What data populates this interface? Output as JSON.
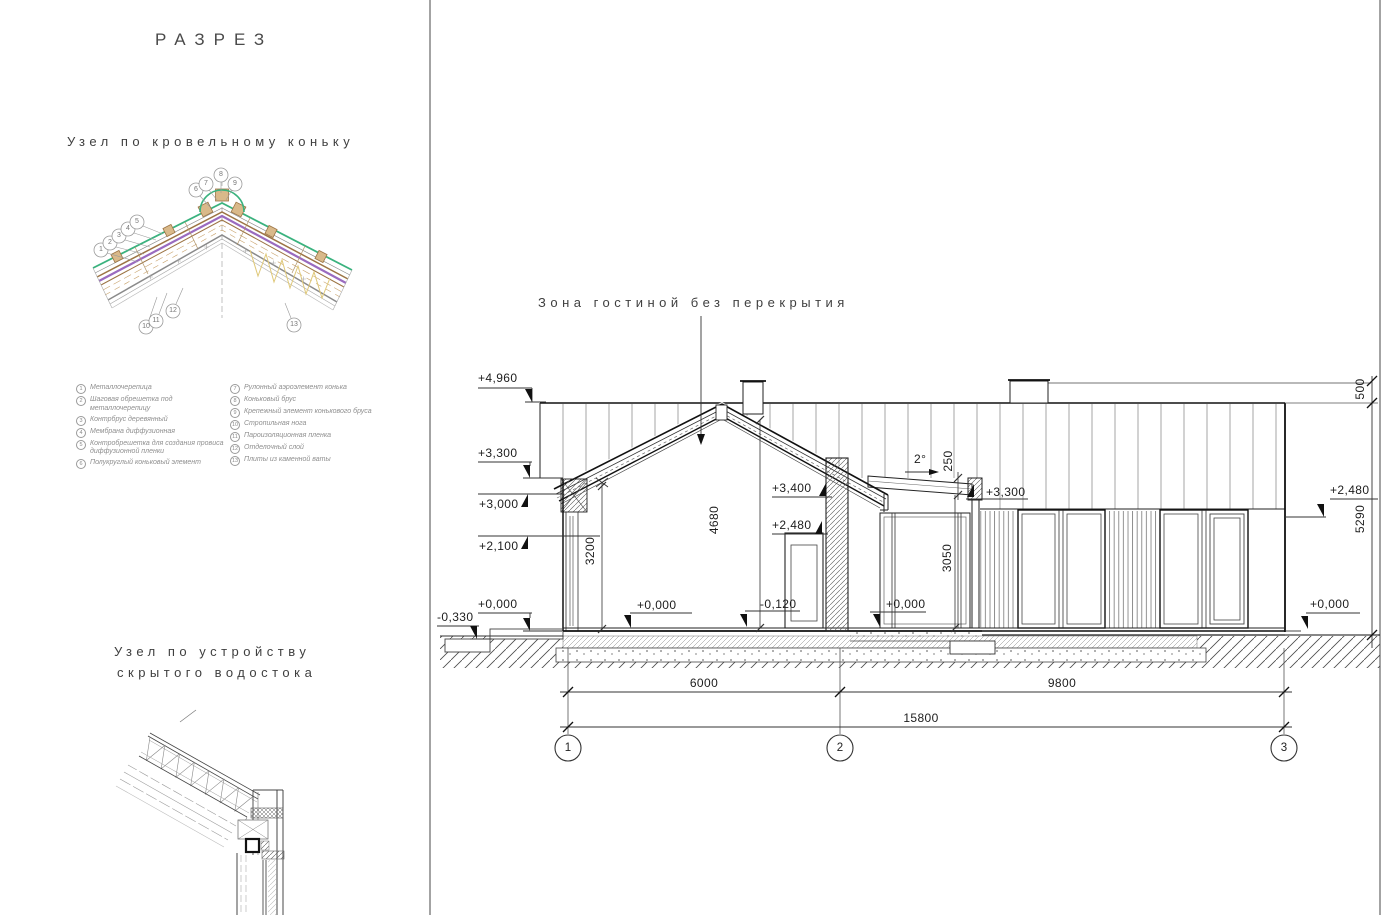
{
  "left_panel": {
    "title": "РАЗРЕЗ",
    "ridge": {
      "heading": "Узел по кровельному коньку",
      "legend_left": [
        {
          "num": "1",
          "text": "Металлочерепица"
        },
        {
          "num": "2",
          "text": "Шаговая обрешетка под металлочерепицу"
        },
        {
          "num": "3",
          "text": "Контрбрус деревянный"
        },
        {
          "num": "4",
          "text": "Мембрана диффузионная"
        },
        {
          "num": "5",
          "text": "Контробрешетка для создания провиса диффузионной пленки"
        },
        {
          "num": "6",
          "text": "Полукруглый коньковый элемент"
        }
      ],
      "legend_right": [
        {
          "num": "7",
          "text": "Рулонный аэроэлемент конька"
        },
        {
          "num": "8",
          "text": "Коньковый брус"
        },
        {
          "num": "9",
          "text": "Крепежный элемент конькового бруса"
        },
        {
          "num": "10",
          "text": "Стропильная нога"
        },
        {
          "num": "11",
          "text": "Пароизоляционная пленка"
        },
        {
          "num": "12",
          "text": "Отделочный слой"
        },
        {
          "num": "13",
          "text": "Плиты из каменной ваты"
        }
      ],
      "callouts": [
        "1",
        "2",
        "3",
        "4",
        "5",
        "6",
        "7",
        "8",
        "9",
        "10",
        "11",
        "12",
        "13"
      ]
    },
    "gutter": {
      "heading1": "Узел по устройству",
      "heading2": "скрытого водостока"
    }
  },
  "section": {
    "zone_label": "Зона гостиной без перекрытия",
    "marks": {
      "m4960": "+4,960",
      "m3300l": "+3,300",
      "m3000": "+3,000",
      "m2100": "+2,100",
      "m0l": "+0,000",
      "mm330": "-0,330",
      "m0int": "+0,000",
      "mm120": "-0,120",
      "m0ter": "+0,000",
      "m3400": "+3,400",
      "m2480m": "+2,480",
      "m3300r": "+3,300",
      "m2480r": "+2,480",
      "m0r": "+0,000",
      "slope": "2°"
    },
    "dims": {
      "d3200": "3200",
      "d4680": "4680",
      "d3050": "3050",
      "d250": "250",
      "d500": "500",
      "d5290": "5290",
      "d6000": "6000",
      "d9800": "9800",
      "d15800": "15800"
    },
    "axes": [
      "1",
      "2",
      "3"
    ]
  },
  "colors": {
    "line_dark": "#111111",
    "line_gray": "#888888",
    "metal_tile_green": "#3ab27e",
    "membrane_purple": "#9a6bbf",
    "timber_brown": "#9c7444",
    "timber_tan": "#d9b98a",
    "insulation_yellow": "#dfc878"
  }
}
